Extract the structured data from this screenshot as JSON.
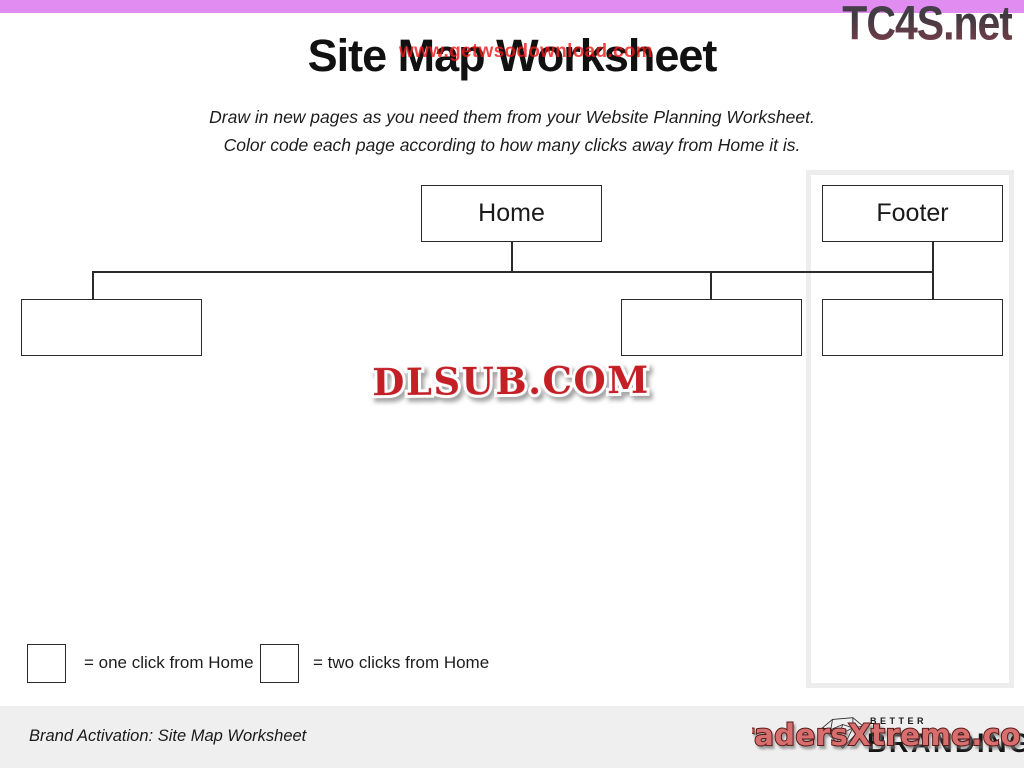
{
  "watermarks": {
    "top_right": "TC4S.net",
    "title_overlay": "www.getwsodownload.com",
    "center_badge": "DLSUB.COM",
    "bottom_right": "TradersXtreme.com"
  },
  "header": {
    "title": "Site Map Worksheet",
    "instructions_line1": "Draw in new pages as you need them from your Website Planning Worksheet.",
    "instructions_line2": "Color code each page according to how many clicks away from Home it is."
  },
  "diagram": {
    "home_label": "Home",
    "footer_label": "Footer",
    "empty_boxes_count": 3
  },
  "legend": {
    "one_click": "= one click from Home",
    "two_clicks": "= two clicks from Home"
  },
  "footer": {
    "caption": "Brand Activation: Site Map Worksheet",
    "brand_line1": "BETTER",
    "brand_line2": "BRANDING"
  },
  "colors": {
    "top_bar": "#e18cf0",
    "overlay_red": "#f01818",
    "badge_red": "#c41f25",
    "traders_fill": "#d76f6f",
    "bottom_strip": "#efefef",
    "frame_gray": "#ededed"
  }
}
